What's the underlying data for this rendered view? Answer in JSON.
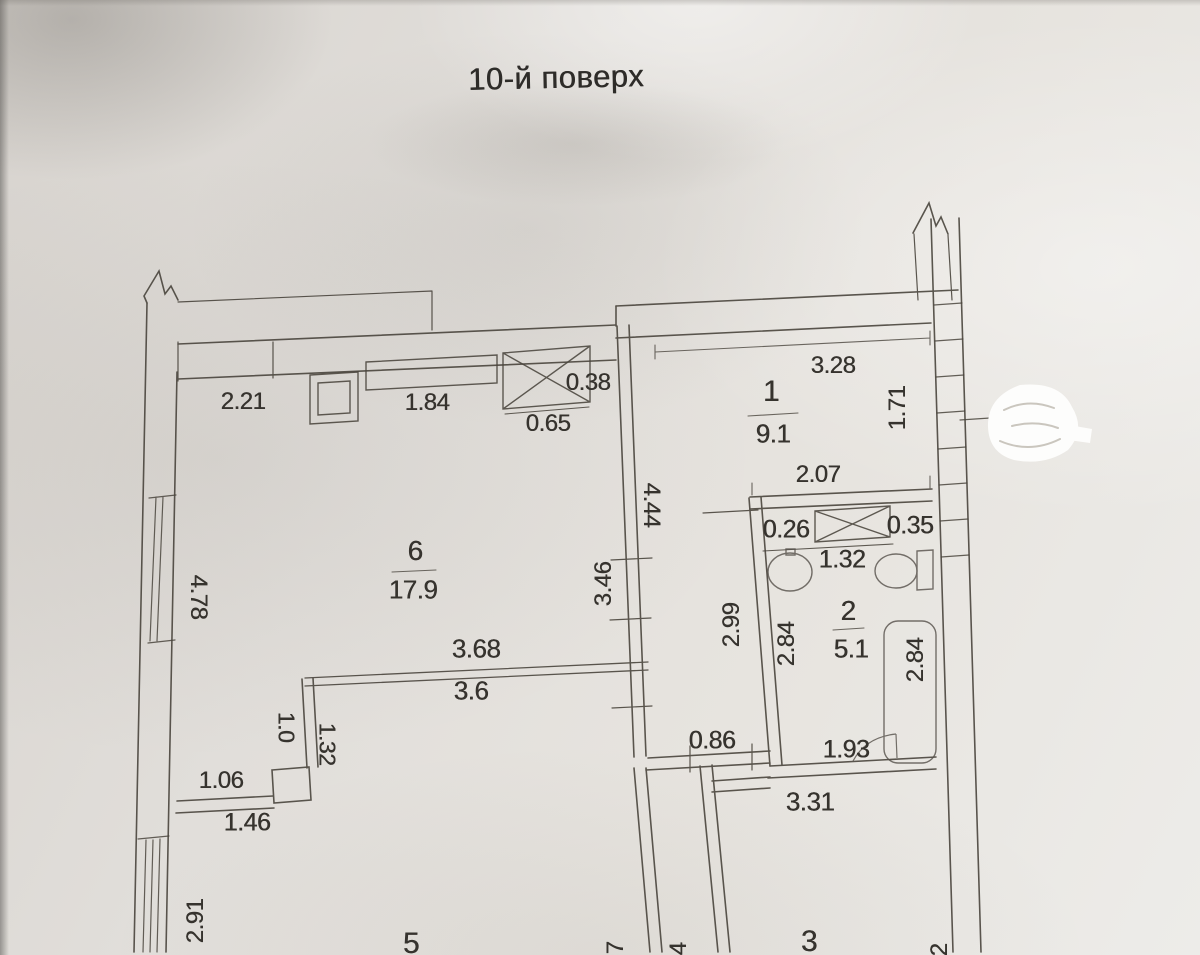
{
  "title": "10-й поверх",
  "rooms": {
    "r1": {
      "number": "1",
      "area": "9.1"
    },
    "r2": {
      "number": "2",
      "area": "5.1"
    },
    "r3": {
      "number": "3"
    },
    "r5": {
      "number": "5"
    },
    "r6": {
      "number": "6",
      "area": "17.9"
    }
  },
  "dims": {
    "kitchen_wall_top": "2.21",
    "niche_width": "1.84",
    "vent_depth": "0.38",
    "vent_width": "0.65",
    "room1_width_top": "3.28",
    "room1_window": "1.71",
    "room1_width_bottom": "2.07",
    "bath_vent_left": "0.26",
    "bath_vent_right": "0.35",
    "bath_vent_width": "1.32",
    "bath_height_left": "2.84",
    "bath_height_right": "2.84",
    "hall_height": "2.99",
    "bath_width_bottom": "1.93",
    "room6_width_inner": "3.68",
    "room6_width_floor": "3.6",
    "left_wall_window": "4.78",
    "mid_wall_upper": "4.44",
    "mid_wall_lower": "3.46",
    "closet_depth": "1.0",
    "closet_width": "1.32",
    "closet_top": "1.06",
    "closet_bottom": "1.46",
    "hall_door": "0.86",
    "hall_width": "3.31",
    "room5_window": "2.91",
    "cut_left": "7",
    "cut_mid": "4",
    "cut_right": "2"
  }
}
